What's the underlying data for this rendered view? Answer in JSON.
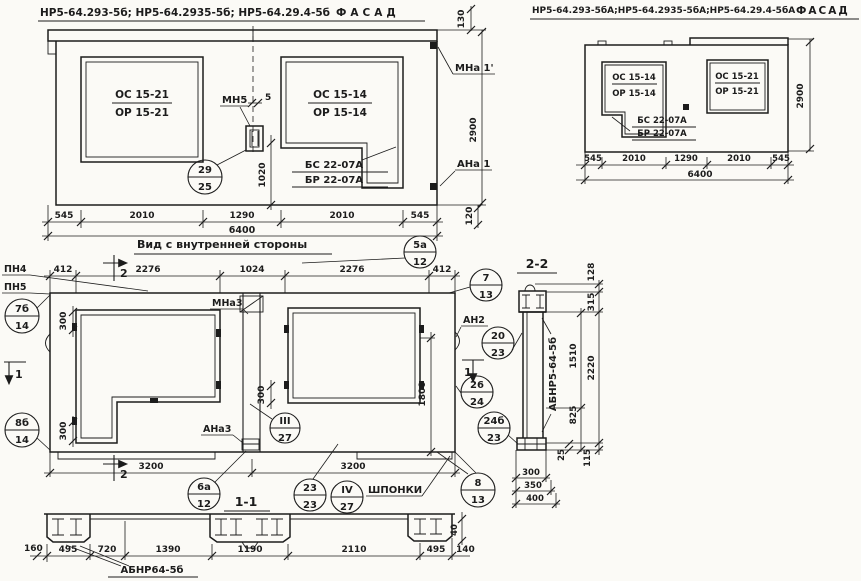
{
  "titles": {
    "main_facade_codes": "НР5-64.293-5б; НР5-64.2935-5б; НР5-64.29.4-5б",
    "main_facade_word": "ФАСАД",
    "alt_facade_codes": "НР5-64.293-5бА;НР5-64.2935-5бА;НР5-64.29.4-5бА",
    "alt_facade_word": "ФАСАД",
    "inner_view": "Вид с внутренней стороны",
    "section_1_1": "1-1",
    "section_2_2": "2-2"
  },
  "main_facade": {
    "win_left_top": "ОС 15-21",
    "win_left_bot": "ОР 15-21",
    "win_right_top": "ОС 15-14",
    "win_right_bot": "ОР 15-14",
    "balcony_top": "БС 22-07А",
    "balcony_bot": "БР 22-07А",
    "anchor_label": "МН5",
    "anchor_dim": "5",
    "dim_v1020": "1020",
    "label_mna1": "МНа 1'",
    "label_ana1": "АНа 1",
    "dim_130": "130",
    "dim_2900": "2900",
    "dim_120": "120",
    "dims_row": [
      "545",
      "2010",
      "1290",
      "2010",
      "545"
    ],
    "dim_total": "6400",
    "balloon_29_25": {
      "top": "29",
      "bot": "25"
    }
  },
  "alt_facade": {
    "win_left_top": "ОС 15-14",
    "win_left_bot": "ОР 15-14",
    "win_right_top": "ОС 15-21",
    "win_right_bot": "ОР 15-21",
    "balcony_top": "БС 22-07А",
    "balcony_bot": "БР 22-07А",
    "dim_2900": "2900",
    "dims_row": [
      "545",
      "2010",
      "1290",
      "2010",
      "545"
    ],
    "dim_total": "6400"
  },
  "inner_view": {
    "label_pn4": "ПН4",
    "label_pn5": "ПН5",
    "dims_top": [
      "412",
      "2276",
      "1024",
      "2276",
      "412"
    ],
    "label_mna3": "МНа3",
    "label_ana3": "АНа3",
    "label_an2": "АН2",
    "label_shponki": "ШПОНКИ",
    "dim_300a": "300",
    "dim_300b": "300",
    "dim_300c": "300",
    "dim_v1800": "1800",
    "dims_bottom": [
      "3200",
      "3200"
    ],
    "mark_1": "1",
    "mark_2": "2",
    "balloons": {
      "b7b14": {
        "top": "7б",
        "bot": "14"
      },
      "b8b14": {
        "top": "8б",
        "bot": "14"
      },
      "b5a12": {
        "top": "5а",
        "bot": "12"
      },
      "b713": {
        "top": "7",
        "bot": "13"
      },
      "b2023": {
        "top": "20",
        "bot": "23"
      },
      "b2624": {
        "top": "26",
        "bot": "24"
      },
      "b24b23": {
        "top": "24б",
        "bot": "23"
      },
      "b813": {
        "top": "8",
        "bot": "13"
      },
      "b327": {
        "top": "III",
        "bot": "27"
      },
      "b2323": {
        "top": "23",
        "bot": "23"
      },
      "b427": {
        "top": "IV",
        "bot": "27"
      },
      "b6a12": {
        "top": "6а",
        "bot": "12"
      }
    }
  },
  "section22": {
    "panel_label": "АБНР5-64-5б",
    "d128": "128",
    "d315": "315",
    "d1510": "1510",
    "d2220": "2220",
    "d825": "825",
    "d25": "25",
    "d115": "115",
    "d300": "300",
    "d350": "350",
    "d400": "400"
  },
  "section11": {
    "label": "АБНР64-5б",
    "dim_160": "160",
    "dim_40": "40",
    "dim_140": "140",
    "dims_row": [
      "495",
      "720",
      "1390",
      "1190",
      "2110",
      "495"
    ]
  }
}
